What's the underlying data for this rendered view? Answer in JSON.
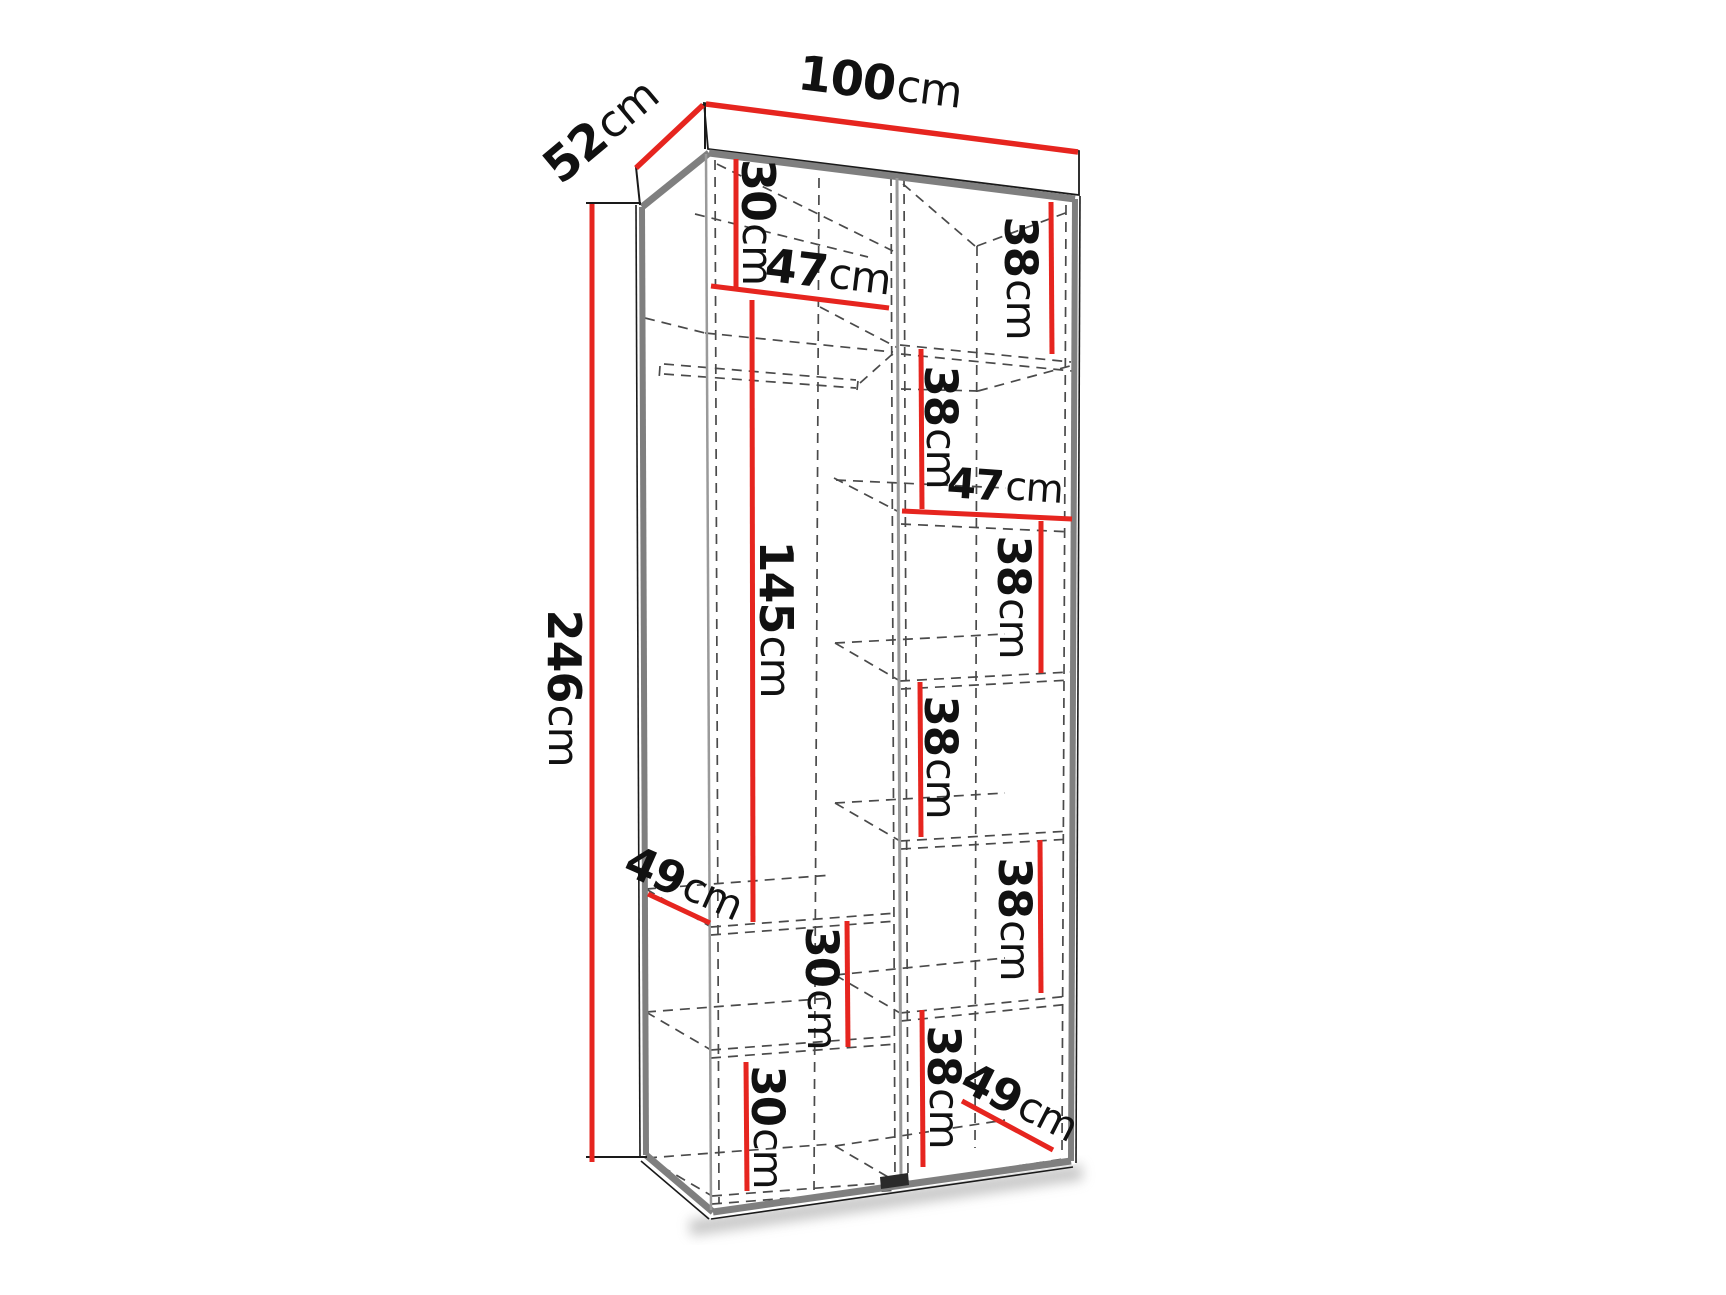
{
  "figure": {
    "kind": "wardrobe-dimension-diagram",
    "description": "Perspective line drawing of a two-column wardrobe carcass with dashed hidden shelves, a clothes rail, and red dimension lines with centimetre labels",
    "canvas": {
      "width": 1726,
      "height": 1295,
      "background": "#ffffff"
    }
  },
  "palette": {
    "dimension_red": "#e6251f",
    "outline_black": "#1a1a1a",
    "carcass_gray": "#7f7f7f",
    "inner_gray": "#9a9a9a",
    "dash_gray": "#4a4a4a",
    "notch_dark": "#2a2a2a",
    "shadow_gray": "#9a9a9a",
    "text_black": "#111111"
  },
  "overall_dimensions": {
    "height": "246cm",
    "width": "100cm",
    "depth": "52cm"
  },
  "dim_labels": [
    {
      "id": "width-100",
      "value": "100",
      "unit": "cm",
      "x": 880,
      "y": 83,
      "rot": 7,
      "size": 48
    },
    {
      "id": "depth-52",
      "value": "52",
      "unit": "cm",
      "x": 601,
      "y": 131,
      "rot": -40,
      "size": 48
    },
    {
      "id": "height-246",
      "value": "246",
      "unit": "cm",
      "x": 564,
      "y": 688,
      "rot": 90,
      "size": 46
    },
    {
      "id": "top-shelf-30",
      "value": "30",
      "unit": "cm",
      "x": 758,
      "y": 222,
      "rot": 90,
      "size": 46
    },
    {
      "id": "left-width-47",
      "value": "47",
      "unit": "cm",
      "x": 828,
      "y": 272,
      "rot": 7,
      "size": 46
    },
    {
      "id": "hanging-145",
      "value": "145",
      "unit": "cm",
      "x": 776,
      "y": 619,
      "rot": 90,
      "size": 46
    },
    {
      "id": "right-38-1",
      "value": "38",
      "unit": "cm",
      "x": 1021,
      "y": 278,
      "rot": 90,
      "size": 45
    },
    {
      "id": "right-38-2",
      "value": "38",
      "unit": "cm",
      "x": 941,
      "y": 427,
      "rot": 90,
      "size": 45
    },
    {
      "id": "right-width-47",
      "value": "47",
      "unit": "cm",
      "x": 1005,
      "y": 486,
      "rot": 4,
      "size": 42
    },
    {
      "id": "right-38-3",
      "value": "38",
      "unit": "cm",
      "x": 1014,
      "y": 597,
      "rot": 90,
      "size": 45
    },
    {
      "id": "right-38-4",
      "value": "38",
      "unit": "cm",
      "x": 941,
      "y": 757,
      "rot": 90,
      "size": 45
    },
    {
      "id": "right-38-5",
      "value": "38",
      "unit": "cm",
      "x": 1015,
      "y": 919,
      "rot": 90,
      "size": 45
    },
    {
      "id": "right-38-6",
      "value": "38",
      "unit": "cm",
      "x": 944,
      "y": 1087,
      "rot": 90,
      "size": 45
    },
    {
      "id": "depth-49-left",
      "value": "49",
      "unit": "cm",
      "x": 684,
      "y": 883,
      "rot": 24,
      "size": 45
    },
    {
      "id": "depth-49-right",
      "value": "49",
      "unit": "cm",
      "x": 1020,
      "y": 1102,
      "rot": 27,
      "size": 45
    },
    {
      "id": "left-30-mid",
      "value": "30",
      "unit": "cm",
      "x": 822,
      "y": 988,
      "rot": 90,
      "size": 45
    },
    {
      "id": "left-30-low",
      "value": "30",
      "unit": "cm",
      "x": 768,
      "y": 1127,
      "rot": 90,
      "size": 45
    }
  ],
  "dim_lines": [
    {
      "id": "width-100",
      "pts": [
        706,
        104,
        1078,
        152
      ],
      "w": 5.5
    },
    {
      "id": "depth-52",
      "pts": [
        636,
        168,
        703,
        105
      ],
      "w": 5.5
    },
    {
      "id": "height-246",
      "pts": [
        592,
        204,
        592,
        1162
      ],
      "w": 5
    },
    {
      "id": "top-shelf-30",
      "pts": [
        736,
        159,
        736,
        288
      ],
      "w": 5
    },
    {
      "id": "left-width-47",
      "pts": [
        711,
        286,
        889,
        308
      ],
      "w": 5
    },
    {
      "id": "hanging-145",
      "pts": [
        752,
        300,
        753,
        922
      ],
      "w": 5
    },
    {
      "id": "right-38-1",
      "pts": [
        1051,
        202,
        1052,
        354
      ],
      "w": 5
    },
    {
      "id": "right-38-2",
      "pts": [
        921,
        349,
        922,
        509
      ],
      "w": 5
    },
    {
      "id": "right-width-47",
      "pts": [
        902,
        511,
        1072,
        519
      ],
      "w": 5
    },
    {
      "id": "right-38-3",
      "pts": [
        1041,
        521,
        1041,
        673
      ],
      "w": 5
    },
    {
      "id": "right-38-4",
      "pts": [
        920,
        682,
        921,
        837
      ],
      "w": 5
    },
    {
      "id": "right-38-5",
      "pts": [
        1040,
        840,
        1041,
        993
      ],
      "w": 5
    },
    {
      "id": "right-38-6",
      "pts": [
        922,
        1010,
        923,
        1167
      ],
      "w": 5
    },
    {
      "id": "depth-49-left",
      "pts": [
        648,
        894,
        710,
        923
      ],
      "w": 5
    },
    {
      "id": "depth-49-right",
      "pts": [
        962,
        1101,
        1053,
        1150
      ],
      "w": 5
    },
    {
      "id": "left-30-mid",
      "pts": [
        847,
        921,
        848,
        1047
      ],
      "w": 5
    },
    {
      "id": "left-30-low",
      "pts": [
        746,
        1062,
        747,
        1191
      ],
      "w": 5
    }
  ],
  "structure": {
    "body_polygon": "636,204 706,147 1080,195 1076,1164 711,1219 640,1158",
    "crown_polygon": "704,103 1079,151 1079,195 708,149",
    "gray_edges": [
      {
        "id": "top-left-edge",
        "pts": [
          642,
          207,
          709,
          153
        ],
        "w": 7,
        "c": "carcass_gray"
      },
      {
        "id": "top-edge",
        "pts": [
          709,
          153,
          1075,
          199
        ],
        "w": 7,
        "c": "carcass_gray"
      },
      {
        "id": "left-edge",
        "pts": [
          642,
          207,
          646,
          1155
        ],
        "w": 6,
        "c": "carcass_gray"
      },
      {
        "id": "bottom-left-edge",
        "pts": [
          646,
          1155,
          713,
          1212
        ],
        "w": 7,
        "c": "carcass_gray"
      },
      {
        "id": "bottom-edge",
        "pts": [
          713,
          1212,
          1071,
          1161
        ],
        "w": 7,
        "c": "carcass_gray"
      },
      {
        "id": "right-edge",
        "pts": [
          1075,
          199,
          1071,
          1161
        ],
        "w": 6,
        "c": "carcass_gray"
      },
      {
        "id": "inner-left-corner",
        "pts": [
          706,
          154,
          711,
          1210
        ],
        "w": 2.5,
        "c": "inner_gray"
      },
      {
        "id": "center-divider",
        "pts": [
          897,
          178,
          901,
          1184
        ],
        "w": 3,
        "c": "inner_gray"
      }
    ],
    "black_lines": [
      {
        "id": "tick-top",
        "pts": [
          586,
          203,
          641,
          203
        ],
        "w": 2
      },
      {
        "id": "tick-bottom",
        "pts": [
          586,
          1157,
          647,
          1157
        ],
        "w": 2
      },
      {
        "id": "crown-left-edge",
        "pts": [
          636,
          167,
          704,
          104
        ],
        "w": 2
      },
      {
        "id": "crown-corner",
        "pts": [
          705,
          103,
          705,
          149
        ],
        "w": 2
      },
      {
        "id": "crown-left-drop",
        "pts": [
          636,
          167,
          640,
          205
        ],
        "w": 2
      },
      {
        "id": "left-outer",
        "pts": [
          636,
          205,
          640,
          1157
        ],
        "w": 1.6
      },
      {
        "id": "right-outer",
        "pts": [
          1080,
          196,
          1076,
          1163
        ],
        "w": 1.6
      },
      {
        "id": "bottom-outer",
        "pts": [
          711,
          1219,
          1073,
          1167
        ],
        "w": 1.6
      },
      {
        "id": "bottom-left-outer",
        "pts": [
          641,
          1161,
          709,
          1219
        ],
        "w": 1.6
      }
    ],
    "dashed_lines": [
      {
        "id": "inner-left-wall",
        "pts": [
          715,
          160,
          719,
          1204
        ]
      },
      {
        "id": "divider-back",
        "pts": [
          819,
          178,
          814,
          1190
        ]
      },
      {
        "id": "divider-dash-l",
        "pts": [
          891,
          176,
          895,
          1184
        ]
      },
      {
        "id": "divider-dash-r",
        "pts": [
          904,
          177,
          908,
          1186
        ]
      },
      {
        "id": "right-back-corner",
        "pts": [
          977,
          246,
          975,
          1148
        ]
      },
      {
        "id": "inner-right-wall",
        "pts": [
          1066,
          205,
          1062,
          1152
        ]
      },
      {
        "id": "ceiling-diag-l1",
        "pts": [
          717,
          164,
          893,
          251
        ]
      },
      {
        "id": "ceiling-diag-l2",
        "pts": [
          695,
          214,
          868,
          257
        ]
      },
      {
        "id": "ceiling-diag-r1",
        "pts": [
          903,
          184,
          975,
          246
        ]
      },
      {
        "id": "ceiling-diag-r2",
        "pts": [
          977,
          246,
          1068,
          212
        ]
      },
      {
        "id": "shelf-l1-conn",
        "pts": [
          645,
          318,
          705,
          333
        ]
      },
      {
        "id": "shelf-l1-under",
        "pts": [
          705,
          333,
          893,
          352
        ]
      },
      {
        "id": "rod-top",
        "pts": [
          664,
          364,
          856,
          380
        ]
      },
      {
        "id": "rod-bottom",
        "pts": [
          664,
          374,
          856,
          388
        ]
      },
      {
        "id": "rod-cap-left",
        "pts": [
          660,
          366,
          659,
          380
        ]
      },
      {
        "id": "rod-cap-right",
        "pts": [
          858,
          381,
          857,
          390
        ]
      },
      {
        "id": "rod-diag",
        "pts": [
          860,
          383,
          897,
          350
        ]
      },
      {
        "id": "shelf-l2-conn",
        "pts": [
          646,
          889,
          711,
          927
        ]
      },
      {
        "id": "shelf-l2-front-a",
        "pts": [
          711,
          927,
          897,
          913
        ]
      },
      {
        "id": "shelf-l2-front-b",
        "pts": [
          711,
          935,
          897,
          921
        ]
      },
      {
        "id": "shelf-l2-back",
        "pts": [
          646,
          889,
          832,
          875
        ]
      },
      {
        "id": "shelf-l3-conn",
        "pts": [
          646,
          1012,
          711,
          1050
        ]
      },
      {
        "id": "shelf-l3-front-a",
        "pts": [
          711,
          1050,
          897,
          1036
        ]
      },
      {
        "id": "shelf-l3-front-b",
        "pts": [
          711,
          1058,
          897,
          1044
        ]
      },
      {
        "id": "shelf-l3-back",
        "pts": [
          646,
          1012,
          832,
          998
        ]
      },
      {
        "id": "floor-l-conn",
        "pts": [
          647,
          1158,
          712,
          1196
        ]
      },
      {
        "id": "floor-l-front-a",
        "pts": [
          712,
          1196,
          897,
          1182
        ]
      },
      {
        "id": "floor-l-front-b",
        "pts": [
          712,
          1204,
          897,
          1190
        ]
      },
      {
        "id": "floor-l-back",
        "pts": [
          647,
          1158,
          832,
          1144
        ]
      },
      {
        "id": "shelf-r1-front-a",
        "pts": [
          900,
          345,
          1071,
          362
        ]
      },
      {
        "id": "shelf-r1-front-b",
        "pts": [
          901,
          354,
          1072,
          371
        ]
      },
      {
        "id": "shelf-r1-under-a",
        "pts": [
          901,
          389,
          978,
          391
        ]
      },
      {
        "id": "shelf-r1-under-b",
        "pts": [
          978,
          391,
          1070,
          366
        ]
      },
      {
        "id": "shelf-r1-conn",
        "pts": [
          820,
          307,
          898,
          348
        ]
      },
      {
        "id": "shelf-r2-front",
        "pts": [
          901,
          524,
          1072,
          532
        ]
      },
      {
        "id": "shelf-r2-conn",
        "pts": [
          834,
          478,
          899,
          512
        ]
      },
      {
        "id": "shelf-r2-back",
        "pts": [
          836,
          480,
          1006,
          488
        ]
      },
      {
        "id": "shelf-r3-front-a",
        "pts": [
          900,
          681,
          1070,
          672
        ]
      },
      {
        "id": "shelf-r3-front-b",
        "pts": [
          901,
          689,
          1071,
          680
        ]
      },
      {
        "id": "shelf-r3-conn",
        "pts": [
          835,
          643,
          900,
          681
        ]
      },
      {
        "id": "shelf-r3-back",
        "pts": [
          835,
          643,
          1005,
          634
        ]
      },
      {
        "id": "shelf-r4-front-a",
        "pts": [
          900,
          841,
          1070,
          831
        ]
      },
      {
        "id": "shelf-r4-front-b",
        "pts": [
          901,
          849,
          1071,
          839
        ]
      },
      {
        "id": "shelf-r4-conn",
        "pts": [
          835,
          803,
          900,
          841
        ]
      },
      {
        "id": "shelf-r4-back",
        "pts": [
          835,
          803,
          1005,
          793
        ]
      },
      {
        "id": "shelf-r5-front-a",
        "pts": [
          900,
          1013,
          1070,
          996
        ]
      },
      {
        "id": "shelf-r5-front-b",
        "pts": [
          901,
          1021,
          1071,
          1004
        ]
      },
      {
        "id": "shelf-r5-conn",
        "pts": [
          835,
          975,
          900,
          1013
        ]
      },
      {
        "id": "shelf-r5-back",
        "pts": [
          835,
          975,
          1005,
          958
        ]
      },
      {
        "id": "floor-r-front",
        "pts": [
          900,
          1184,
          1070,
          1158
        ]
      },
      {
        "id": "floor-r-conn",
        "pts": [
          835,
          1146,
          900,
          1184
        ]
      },
      {
        "id": "floor-r-back",
        "pts": [
          835,
          1146,
          1005,
          1120
        ]
      }
    ],
    "notch_polygon": "880,1177 908,1173 909,1185 881,1189",
    "shadow_line": {
      "pts": [
        690,
        1228,
        1082,
        1172
      ],
      "w": 16
    }
  }
}
